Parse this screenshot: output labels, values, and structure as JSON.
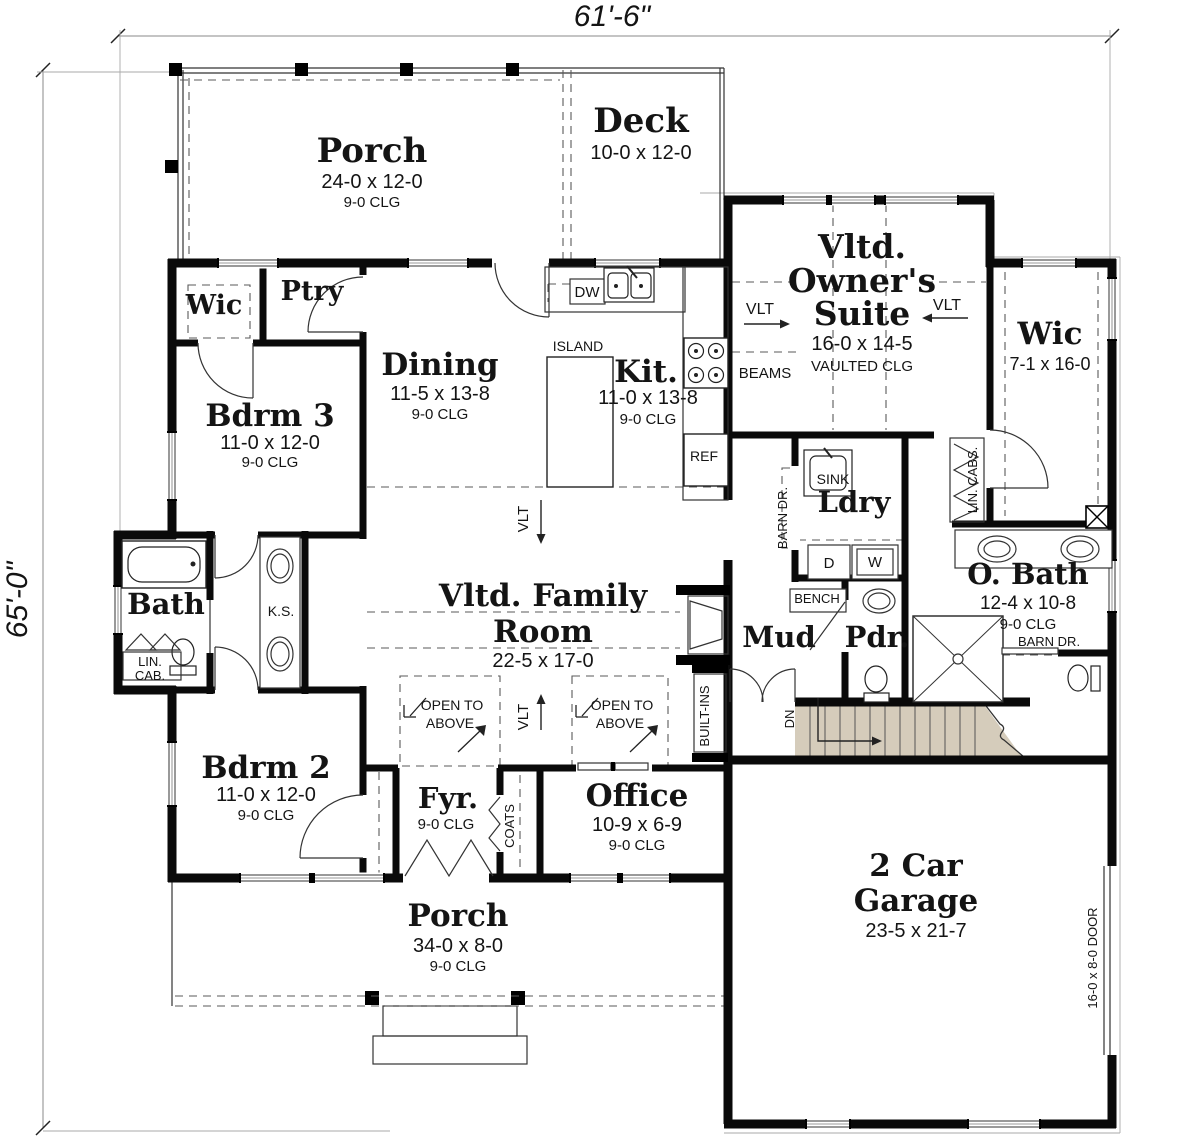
{
  "canvas": {
    "width": 1200,
    "height": 1139
  },
  "colors": {
    "background": "#ffffff",
    "walls": "#0a0a0a",
    "thin_line": "#333333",
    "dashed_line": "#5a5a5a",
    "dim_line": "#8a8a8a",
    "stairs_fill": "#d5ccbb",
    "text": "#141414"
  },
  "dimensions": {
    "overall_width": "61'-6\"",
    "overall_height": "65'-0\""
  },
  "labels": [
    {
      "id": "dim-width",
      "text": "61'-6\"",
      "x": 612,
      "y": 26,
      "size": 30,
      "font": "sans",
      "italic": true
    },
    {
      "id": "dim-height",
      "text": "65'-0\"",
      "x": 27,
      "y": 600,
      "size": 30,
      "font": "sans",
      "italic": true,
      "rotate": -90
    },
    {
      "id": "porch-top-name",
      "text": "Porch",
      "x": 372,
      "y": 162,
      "size": 34,
      "font": "serif",
      "bold": true
    },
    {
      "id": "porch-top-size",
      "text": "24-0 x 12-0",
      "x": 372,
      "y": 188,
      "size": 20,
      "font": "sans"
    },
    {
      "id": "porch-top-clg",
      "text": "9-0 CLG",
      "x": 372,
      "y": 207,
      "size": 15,
      "font": "sans"
    },
    {
      "id": "deck-name",
      "text": "Deck",
      "x": 641,
      "y": 132,
      "size": 34,
      "font": "serif",
      "bold": true
    },
    {
      "id": "deck-size",
      "text": "10-0 x 12-0",
      "x": 641,
      "y": 159,
      "size": 20,
      "font": "sans"
    },
    {
      "id": "suite-name-1",
      "text": "Vltd.",
      "x": 862,
      "y": 258,
      "size": 33,
      "font": "serif",
      "bold": true
    },
    {
      "id": "suite-name-2",
      "text": "Owner's",
      "x": 862,
      "y": 292,
      "size": 33,
      "font": "serif",
      "bold": true
    },
    {
      "id": "suite-name-3",
      "text": "Suite",
      "x": 862,
      "y": 325,
      "size": 33,
      "font": "serif",
      "bold": true
    },
    {
      "id": "suite-size",
      "text": "16-0 x 14-5",
      "x": 862,
      "y": 350,
      "size": 20,
      "font": "sans"
    },
    {
      "id": "suite-clg",
      "text": "VAULTED CLG",
      "x": 862,
      "y": 371,
      "size": 15,
      "font": "sans"
    },
    {
      "id": "vlt-left",
      "text": "VLT",
      "x": 760,
      "y": 314,
      "size": 16,
      "font": "sans"
    },
    {
      "id": "vlt-right",
      "text": "VLT",
      "x": 947,
      "y": 310,
      "size": 16,
      "font": "sans"
    },
    {
      "id": "beams",
      "text": "BEAMS",
      "x": 765,
      "y": 378,
      "size": 15,
      "font": "sans"
    },
    {
      "id": "wic-right-name",
      "text": "Wic",
      "x": 1050,
      "y": 344,
      "size": 31,
      "font": "serif",
      "bold": true
    },
    {
      "id": "wic-right-size",
      "text": "7-1 x 16-0",
      "x": 1050,
      "y": 370,
      "size": 18,
      "font": "sans"
    },
    {
      "id": "wic-left-name",
      "text": "Wic",
      "x": 214,
      "y": 314,
      "size": 27,
      "font": "serif",
      "bold": true
    },
    {
      "id": "ptry-name",
      "text": "Ptry",
      "x": 312,
      "y": 300,
      "size": 27,
      "font": "serif",
      "bold": true
    },
    {
      "id": "dining-name",
      "text": "Dining",
      "x": 440,
      "y": 375,
      "size": 31,
      "font": "serif",
      "bold": true
    },
    {
      "id": "dining-size",
      "text": "11-5 x 13-8",
      "x": 440,
      "y": 400,
      "size": 20,
      "font": "sans"
    },
    {
      "id": "dining-clg",
      "text": "9-0 CLG",
      "x": 440,
      "y": 419,
      "size": 15,
      "font": "sans"
    },
    {
      "id": "island",
      "text": "ISLAND",
      "x": 578,
      "y": 351,
      "size": 14,
      "font": "sans"
    },
    {
      "id": "kit-name",
      "text": "Kit.",
      "x": 646,
      "y": 382,
      "size": 31,
      "font": "serif",
      "bold": true
    },
    {
      "id": "kit-size",
      "text": "11-0 x 13-8",
      "x": 648,
      "y": 404,
      "size": 20,
      "font": "sans"
    },
    {
      "id": "kit-clg",
      "text": "9-0 CLG",
      "x": 648,
      "y": 424,
      "size": 15,
      "font": "sans"
    },
    {
      "id": "dw",
      "text": "DW",
      "x": 587,
      "y": 297,
      "size": 15,
      "font": "sans"
    },
    {
      "id": "ref",
      "text": "REF",
      "x": 704,
      "y": 461,
      "size": 14,
      "font": "sans"
    },
    {
      "id": "bdrm3-name",
      "text": "Bdrm 3",
      "x": 270,
      "y": 426,
      "size": 31,
      "font": "serif",
      "bold": true
    },
    {
      "id": "bdrm3-size",
      "text": "11-0 x 12-0",
      "x": 270,
      "y": 449,
      "size": 20,
      "font": "sans"
    },
    {
      "id": "bdrm3-clg",
      "text": "9-0 CLG",
      "x": 270,
      "y": 467,
      "size": 15,
      "font": "sans"
    },
    {
      "id": "bath-name",
      "text": "Bath",
      "x": 166,
      "y": 614,
      "size": 29,
      "font": "serif",
      "bold": true
    },
    {
      "id": "lincab-1",
      "text": "LIN.",
      "x": 150,
      "y": 666,
      "size": 13,
      "font": "sans"
    },
    {
      "id": "lincab-2",
      "text": "CAB.",
      "x": 150,
      "y": 680,
      "size": 13,
      "font": "sans"
    },
    {
      "id": "ks",
      "text": "K.S.",
      "x": 281,
      "y": 616,
      "size": 14,
      "font": "sans"
    },
    {
      "id": "ldry-sink",
      "text": "SINK",
      "x": 833,
      "y": 484,
      "size": 14,
      "font": "sans"
    },
    {
      "id": "ldry-name",
      "text": "Ldry",
      "x": 854,
      "y": 512,
      "size": 29,
      "font": "serif",
      "bold": true
    },
    {
      "id": "dryer",
      "text": "D",
      "x": 829,
      "y": 568,
      "size": 15,
      "font": "sans"
    },
    {
      "id": "washer",
      "text": "W",
      "x": 875,
      "y": 567,
      "size": 15,
      "font": "sans"
    },
    {
      "id": "barn-dr-left",
      "text": "BARN DR.",
      "x": 787,
      "y": 518,
      "size": 13,
      "font": "sans",
      "rotate": -90
    },
    {
      "id": "lin-cabs",
      "text": "LIN. CABS.",
      "x": 977,
      "y": 480,
      "size": 13,
      "font": "sans",
      "rotate": -90
    },
    {
      "id": "obath-name",
      "text": "O. Bath",
      "x": 1028,
      "y": 584,
      "size": 29,
      "font": "serif",
      "bold": true
    },
    {
      "id": "obath-size",
      "text": "12-4 x 10-8",
      "x": 1028,
      "y": 609,
      "size": 19,
      "font": "sans"
    },
    {
      "id": "obath-clg",
      "text": "9-0 CLG",
      "x": 1028,
      "y": 629,
      "size": 15,
      "font": "sans"
    },
    {
      "id": "barn-dr-right",
      "text": "BARN DR.",
      "x": 1049,
      "y": 646,
      "size": 13,
      "font": "sans"
    },
    {
      "id": "bench",
      "text": "BENCH",
      "x": 817,
      "y": 603,
      "size": 13,
      "font": "sans"
    },
    {
      "id": "mud-name",
      "text": "Mud",
      "x": 779,
      "y": 647,
      "size": 29,
      "font": "serif",
      "bold": true
    },
    {
      "id": "pdr-name",
      "text": "Pdr.",
      "x": 877,
      "y": 647,
      "size": 29,
      "font": "serif",
      "bold": true
    },
    {
      "id": "family-name-1",
      "text": "Vltd. Family",
      "x": 543,
      "y": 606,
      "size": 31,
      "font": "serif",
      "bold": true
    },
    {
      "id": "family-name-2",
      "text": "Room",
      "x": 543,
      "y": 642,
      "size": 31,
      "font": "serif",
      "bold": true
    },
    {
      "id": "family-size",
      "text": "22-5 x 17-0",
      "x": 543,
      "y": 667,
      "size": 20,
      "font": "sans"
    },
    {
      "id": "vlt-family-top",
      "text": "VLT",
      "x": 528,
      "y": 519,
      "size": 15,
      "font": "sans",
      "rotate": -90
    },
    {
      "id": "vlt-family-bottom",
      "text": "VLT",
      "x": 528,
      "y": 717,
      "size": 15,
      "font": "sans",
      "rotate": -90
    },
    {
      "id": "open-above-1a",
      "text": "OPEN TO",
      "x": 452,
      "y": 710,
      "size": 14,
      "font": "sans"
    },
    {
      "id": "open-above-1b",
      "text": "ABOVE",
      "x": 450,
      "y": 728,
      "size": 14,
      "font": "sans"
    },
    {
      "id": "open-above-2a",
      "text": "OPEN TO",
      "x": 622,
      "y": 710,
      "size": 14,
      "font": "sans"
    },
    {
      "id": "open-above-2b",
      "text": "ABOVE",
      "x": 620,
      "y": 728,
      "size": 14,
      "font": "sans"
    },
    {
      "id": "built-ins",
      "text": "BUILT-INS",
      "x": 709,
      "y": 716,
      "size": 13,
      "font": "sans",
      "rotate": -90
    },
    {
      "id": "dn",
      "text": "DN",
      "x": 794,
      "y": 719,
      "size": 13,
      "font": "sans",
      "rotate": -90
    },
    {
      "id": "bdrm2-name",
      "text": "Bdrm 2",
      "x": 266,
      "y": 778,
      "size": 31,
      "font": "serif",
      "bold": true
    },
    {
      "id": "bdrm2-size",
      "text": "11-0 x 12-0",
      "x": 266,
      "y": 801,
      "size": 20,
      "font": "sans"
    },
    {
      "id": "bdrm2-clg",
      "text": "9-0 CLG",
      "x": 266,
      "y": 820,
      "size": 15,
      "font": "sans"
    },
    {
      "id": "fyr-name",
      "text": "Fyr.",
      "x": 448,
      "y": 808,
      "size": 29,
      "font": "serif",
      "bold": true
    },
    {
      "id": "fyr-clg",
      "text": "9-0 CLG",
      "x": 446,
      "y": 829,
      "size": 15,
      "font": "sans"
    },
    {
      "id": "coats",
      "text": "COATS",
      "x": 514,
      "y": 826,
      "size": 13,
      "font": "sans",
      "rotate": -90
    },
    {
      "id": "office-name",
      "text": "Office",
      "x": 637,
      "y": 806,
      "size": 31,
      "font": "serif",
      "bold": true
    },
    {
      "id": "office-size",
      "text": "10-9 x 6-9",
      "x": 637,
      "y": 831,
      "size": 20,
      "font": "sans"
    },
    {
      "id": "office-clg",
      "text": "9-0 CLG",
      "x": 637,
      "y": 850,
      "size": 15,
      "font": "sans"
    },
    {
      "id": "porch-bottom-name",
      "text": "Porch",
      "x": 458,
      "y": 926,
      "size": 31,
      "font": "serif",
      "bold": true
    },
    {
      "id": "porch-bottom-size",
      "text": "34-0 x 8-0",
      "x": 458,
      "y": 952,
      "size": 20,
      "font": "sans"
    },
    {
      "id": "porch-bottom-clg",
      "text": "9-0 CLG",
      "x": 458,
      "y": 971,
      "size": 15,
      "font": "sans"
    },
    {
      "id": "garage-name-1",
      "text": "2 Car",
      "x": 916,
      "y": 876,
      "size": 31,
      "font": "serif",
      "bold": true
    },
    {
      "id": "garage-name-2",
      "text": "Garage",
      "x": 916,
      "y": 911,
      "size": 31,
      "font": "serif",
      "bold": true
    },
    {
      "id": "garage-size",
      "text": "23-5 x 21-7",
      "x": 916,
      "y": 937,
      "size": 20,
      "font": "sans"
    },
    {
      "id": "garage-door",
      "text": "16-0 x 8-0 DOOR",
      "x": 1097,
      "y": 958,
      "size": 13,
      "font": "sans",
      "rotate": -90
    }
  ]
}
